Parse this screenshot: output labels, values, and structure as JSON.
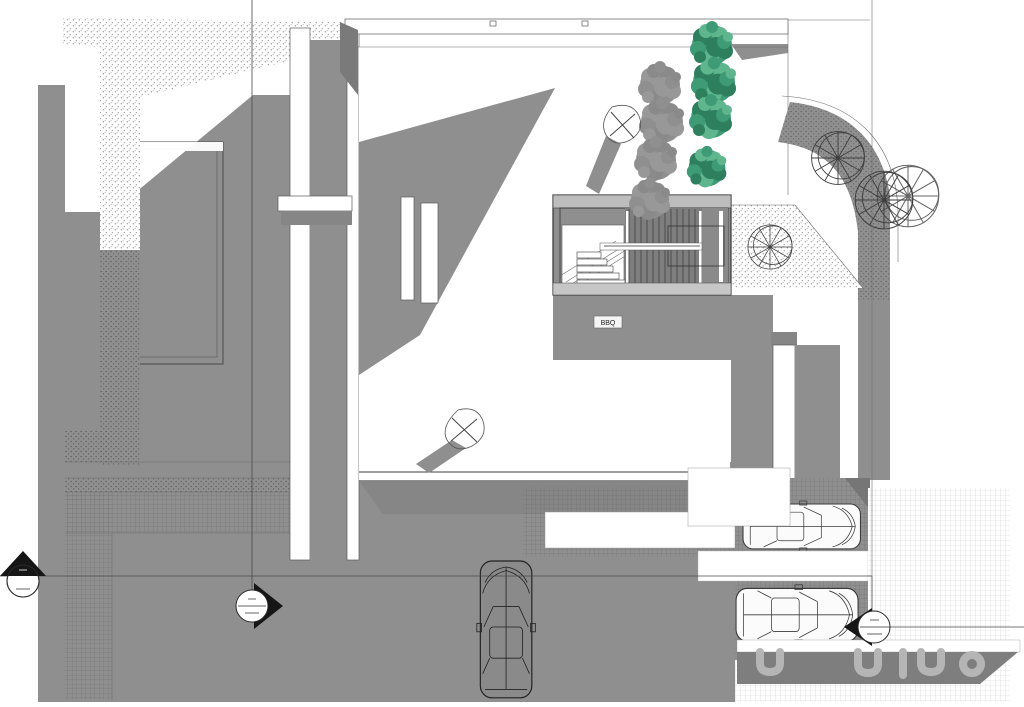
{
  "plan": {
    "title": "Architectural site plan, roof and terrace level with driveway",
    "labels": {
      "bbq": "BBQ"
    },
    "palette": {
      "background": "#ffffff",
      "shadow_gray": "#8f8f8f",
      "shadow_dark": "#7e7e7e",
      "band_light": "#c6c6c6",
      "line_dark": "#3f3f3f",
      "tree_green": "#3e9b76",
      "tree_green_dark": "#2e7f5e",
      "tree_green_light": "#5fb68e",
      "marker_black": "#161616",
      "grid_light": "#cfcfcf",
      "grid_dark": "#6f6f6f",
      "blob_gray": "#b5b5b5"
    },
    "elements": {
      "green_trees": 4,
      "tree_plan_symbols": 4,
      "parked_cars": 2,
      "driveway_cars": 1,
      "section_markers": 3,
      "landscape_spotlights": 2,
      "stairwell": 1
    }
  }
}
